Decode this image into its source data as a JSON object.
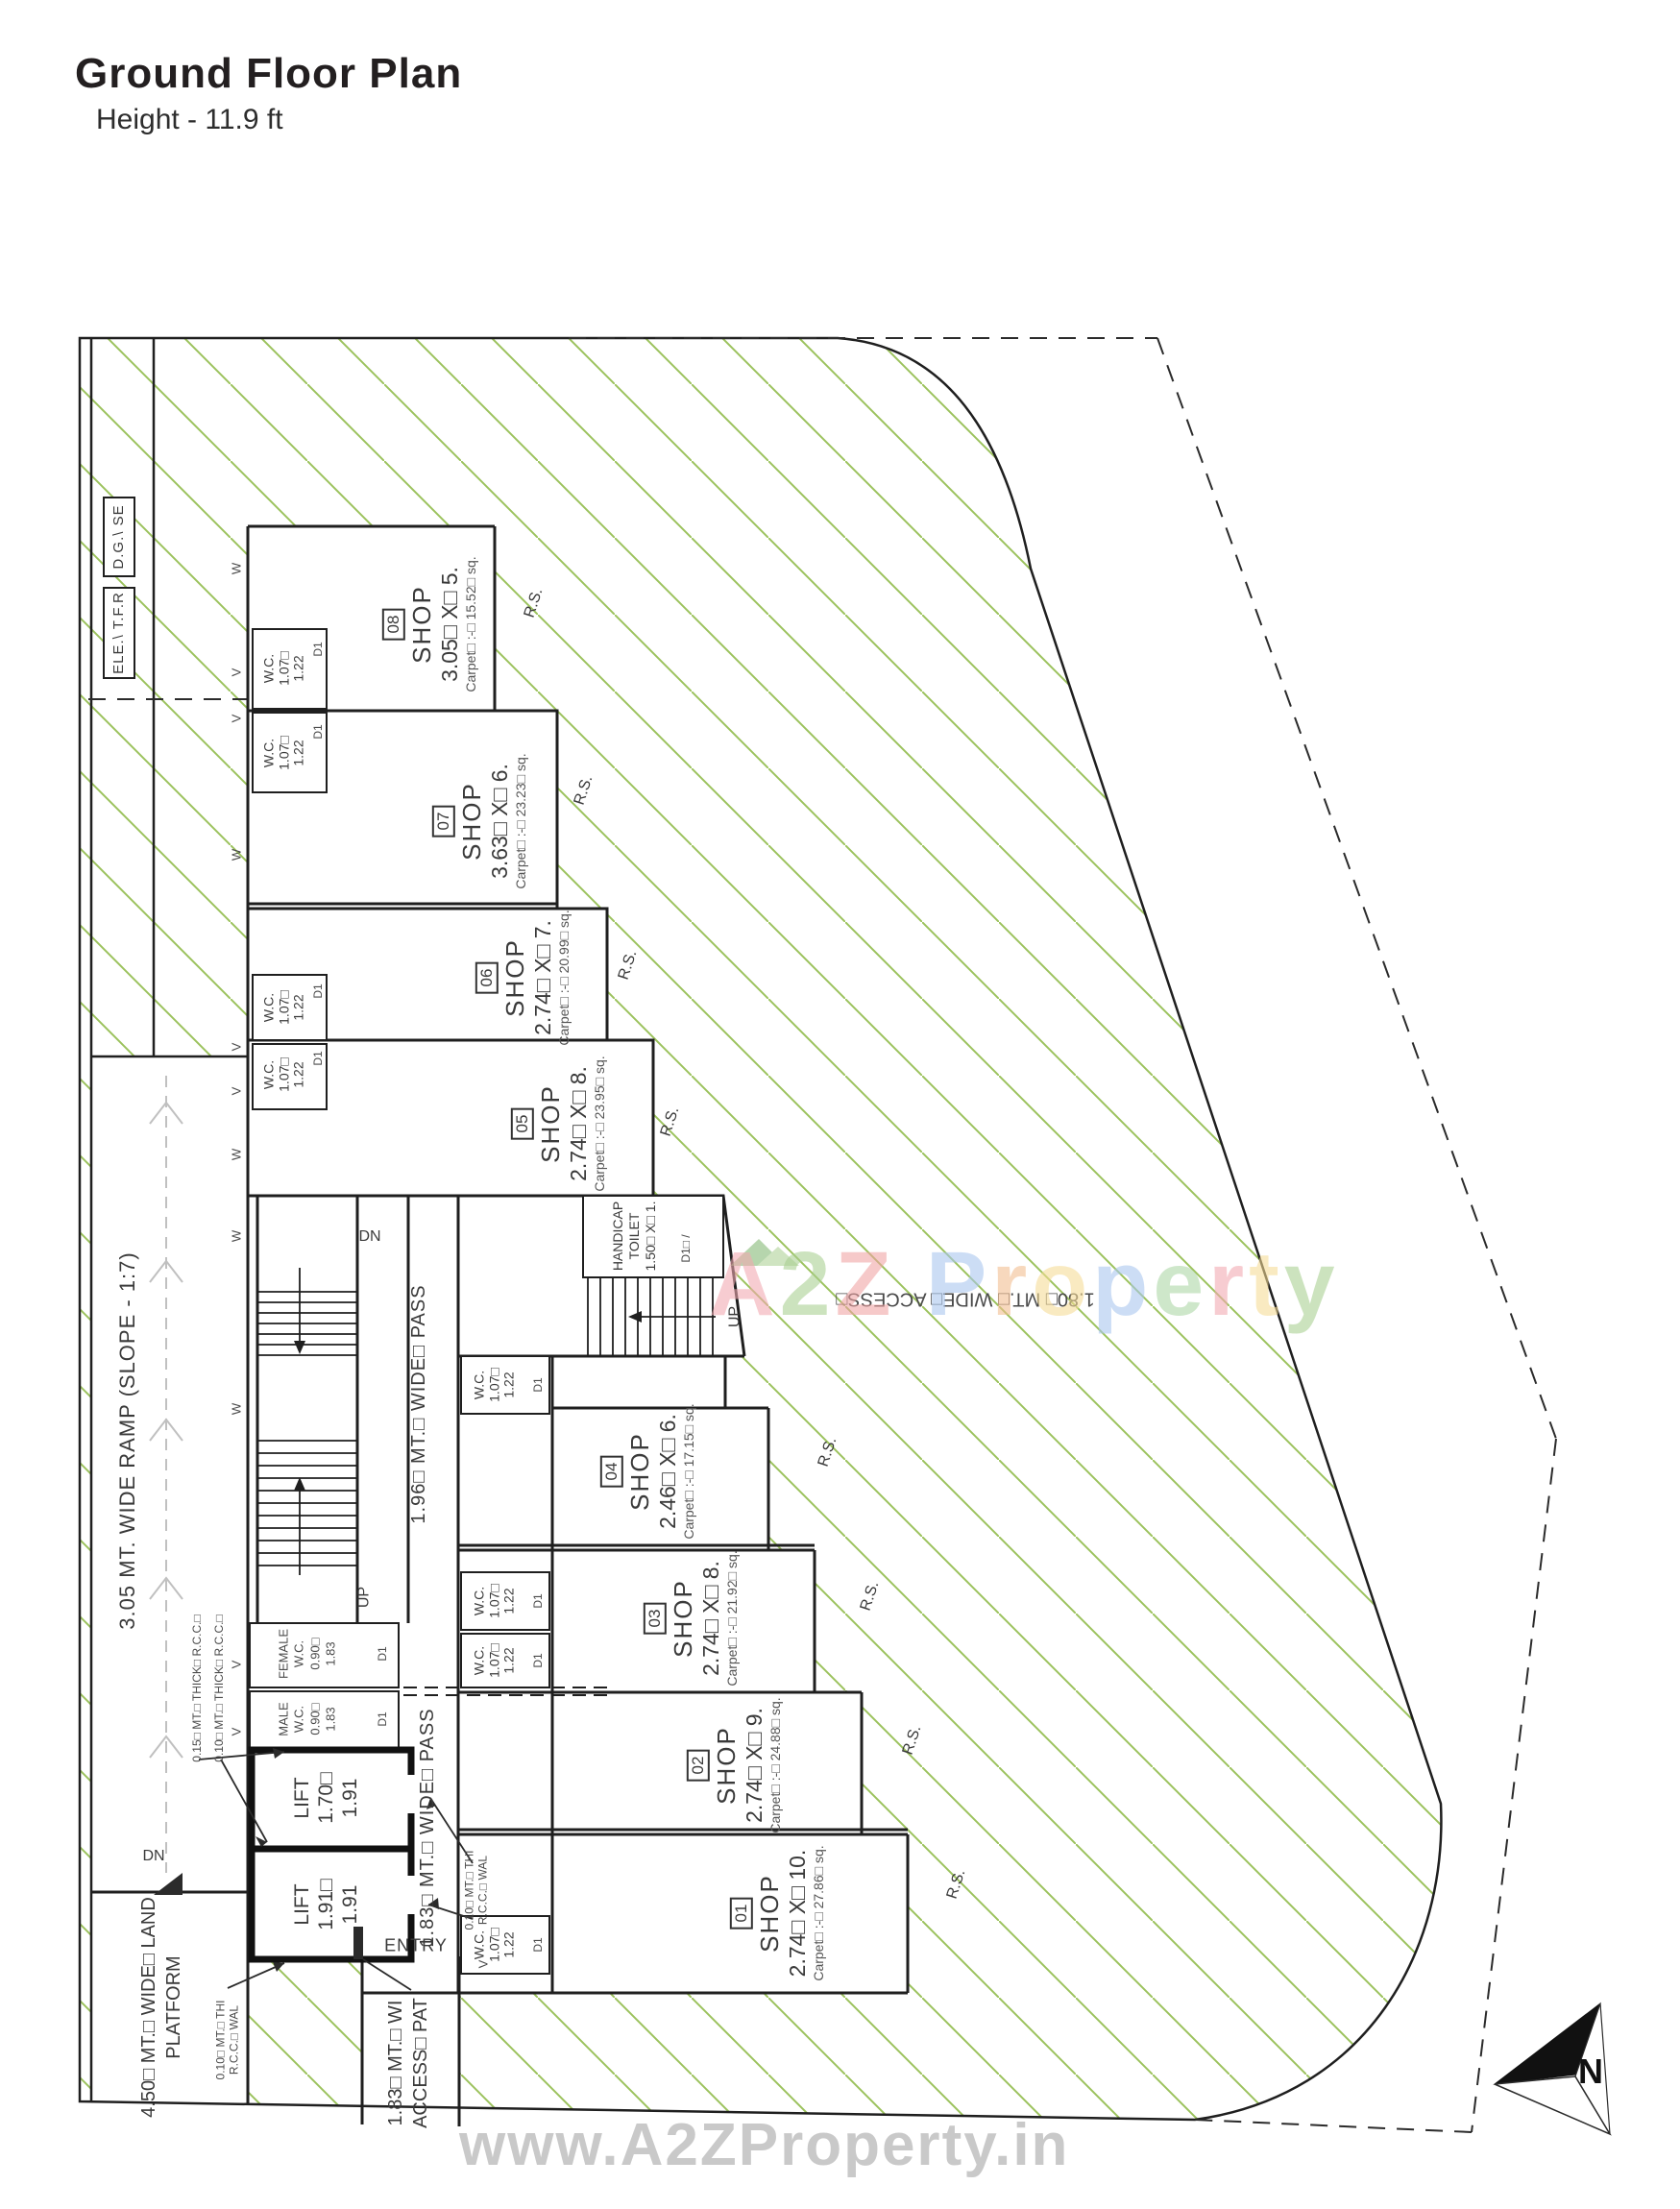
{
  "title": {
    "main": "Ground Floor Plan",
    "subtitle": "Height - 11.9 ft"
  },
  "plan": {
    "utility_boxes": [
      {
        "label": "D.G.\\ SE"
      },
      {
        "label": "ELE.\\ T.F.R"
      }
    ],
    "shops": [
      {
        "number": "01",
        "name": "SHOP",
        "dims": "2.74□ X□ 10.",
        "carpet": "Carpet□ :-□ 27.86□ sq."
      },
      {
        "number": "02",
        "name": "SHOP",
        "dims": "2.74□ X□ 9.",
        "carpet": "Carpet□ :-□ 24.88□ sq."
      },
      {
        "number": "03",
        "name": "SHOP",
        "dims": "2.74□ X□ 8.",
        "carpet": "Carpet□ :-□ 21.92□ sq."
      },
      {
        "number": "04",
        "name": "SHOP",
        "dims": "2.46□ X□ 6.",
        "carpet": "Carpet□ :-□ 17.15□ sq."
      },
      {
        "number": "05",
        "name": "SHOP",
        "dims": "2.74□ X□ 8.",
        "carpet": "Carpet□ :-□ 23.95□ sq."
      },
      {
        "number": "06",
        "name": "SHOP",
        "dims": "2.74□ X□ 7.",
        "carpet": "Carpet□ :-□ 20.99□ sq."
      },
      {
        "number": "07",
        "name": "SHOP",
        "dims": "3.63□ X□ 6.",
        "carpet": "Carpet□ :-□ 23.23□ sq."
      },
      {
        "number": "08",
        "name": "SHOP",
        "dims": "3.05□ X□ 5.",
        "carpet": "Carpet□ :-□ 15.52□ sq."
      }
    ],
    "wc": {
      "line1": "W.C.",
      "line2": "1.07□",
      "line3": "1.22",
      "door": "D1"
    },
    "female_wc": {
      "line1": "FEMALE",
      "line2": "W.C.",
      "line3": "0.90□",
      "line4": "1.83",
      "door": "D1"
    },
    "male_wc": {
      "line1": "MALE",
      "line2": "W.C.",
      "line3": "0.90□",
      "line4": "1.83",
      "door": "D1"
    },
    "handicap": {
      "line1": "HANDICAP",
      "line2": "TOILET",
      "line3": "1.50□ X□ 1.",
      "door": "D1□ /"
    },
    "lifts": [
      {
        "name": "LIFT",
        "w": "1.70□",
        "d": "1.91"
      },
      {
        "name": "LIFT",
        "w": "1.91□",
        "d": "1.91"
      }
    ],
    "labels": {
      "ramp": "3.05 MT. WIDE RAMP (SLOPE - 1:7)",
      "pass_196": "1.96□ MT.□ WIDE□ PASS",
      "pass_183": "1.83□ MT.□ WIDE□ PASS",
      "access_180": "1.80□ MT.□ WIDE□ ACCESS□",
      "platform_l1": "4.50□ MT.□ WIDE□ LAND",
      "platform_l2": "PLATFORM",
      "access_path_l1": "1.83□ MT.□ WI",
      "access_path_l2": "ACCESS□ PAT",
      "wall_015_thick": "0.15□ MT.□ THICK□ R.C.C.□",
      "wall_010_thick": "0.10□ MT.□ THICK□ R.C.C.□",
      "wall_010_thi_l1": "0.10□ MT.□ THI",
      "wall_010_thi_l2": "R.C.C.□ WAL",
      "entry": "ENTRY",
      "up": "UP",
      "dn": "DN",
      "rs": "R.S.",
      "window": "W",
      "vent": "V",
      "north": "N"
    }
  },
  "watermark_center": {
    "letters": [
      {
        "ch": "A",
        "c": "#f2a9b0"
      },
      {
        "ch": "2",
        "c": "#a9cf90"
      },
      {
        "ch": "Z",
        "c": "#f0a3a3"
      },
      {
        "ch": " ",
        "c": "#ffffff"
      },
      {
        "ch": "P",
        "c": "#a9c6ee"
      },
      {
        "ch": "r",
        "c": "#f2bd8e"
      },
      {
        "ch": "o",
        "c": "#f6dc95"
      },
      {
        "ch": "p",
        "c": "#a9c6ee"
      },
      {
        "ch": "e",
        "c": "#abd6a5"
      },
      {
        "ch": "r",
        "c": "#f2a9b0"
      },
      {
        "ch": "t",
        "c": "#f6dc95"
      },
      {
        "ch": "y",
        "c": "#a9cf90"
      }
    ]
  },
  "watermark_bottom": {
    "text": "www.A2ZProperty.in"
  },
  "colors": {
    "hatch": "#9cc25d",
    "line": "#1f1f1f",
    "ramp_guide": "#c0c0c0"
  }
}
